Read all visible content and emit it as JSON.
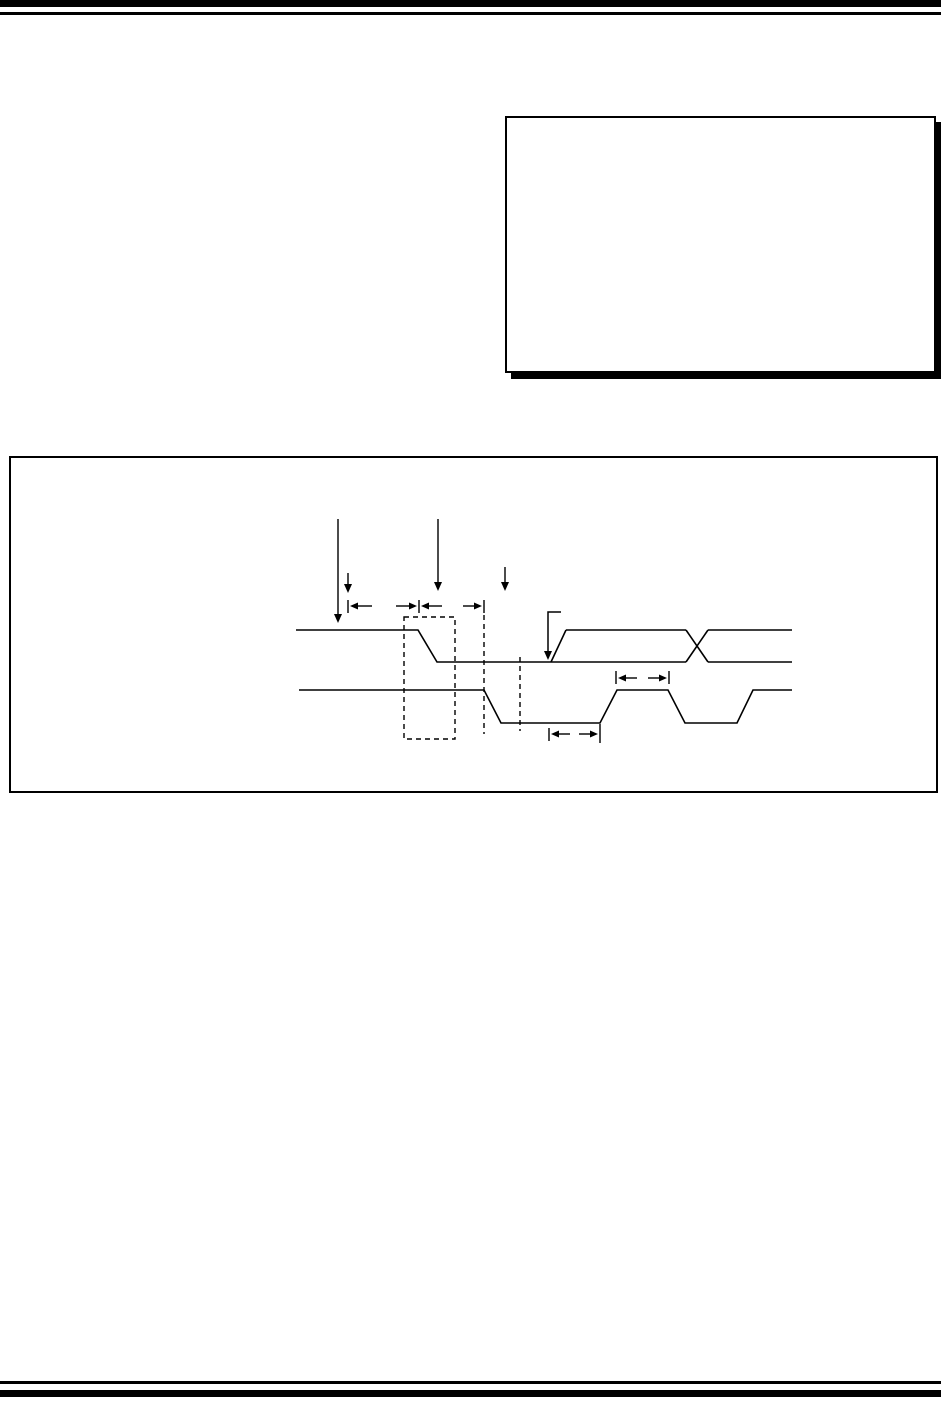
{
  "colors": {
    "ink": "#000000",
    "paper": "#ffffff"
  },
  "figure": {
    "type": "timing-diagram",
    "signals": [
      {
        "name": "signal1-high-fall-low",
        "points": "296,630 418,630 437,662 686,662"
      },
      {
        "name": "signal1-rising-edge",
        "points": "551,662 566,630"
      },
      {
        "name": "signal1-high-segment",
        "points": "566,630 686,630"
      },
      {
        "name": "signal1-crossover-fall",
        "points": "686,630 708,662"
      },
      {
        "name": "signal1-crossover-rise",
        "points": "686,662 708,630"
      },
      {
        "name": "signal1-high-tail",
        "points": "708,630 792,630"
      },
      {
        "name": "signal1-low-tail",
        "points": "708,662 792,662"
      },
      {
        "name": "signal2-waveform",
        "points": "299,690 484,690 501,723 600,723 617,690 668,690 685,723 737,723 753,690 792,690"
      }
    ],
    "down_arrows": [
      {
        "name": "tall-down-arrow-left",
        "x": 338,
        "y1": 519,
        "y2": 623
      },
      {
        "name": "tall-down-arrow-mid",
        "x": 438,
        "y1": 519,
        "y2": 591
      },
      {
        "name": "short-down-arrow-left",
        "x": 348,
        "y1": 573,
        "y2": 593
      },
      {
        "name": "short-down-arrow-mid",
        "x": 505,
        "y1": 567,
        "y2": 591
      }
    ],
    "corner_arrow": {
      "name": "corner-pointer-arrow",
      "points": "561,612 548,612 548,652",
      "tip_x": 548,
      "tip_y": 660
    },
    "ticks": [
      {
        "x": 348,
        "y1": 600,
        "y2": 613
      },
      {
        "x": 419,
        "y1": 600,
        "y2": 613
      },
      {
        "x": 484,
        "y1": 600,
        "y2": 613
      },
      {
        "x": 616,
        "y1": 671,
        "y2": 684
      },
      {
        "x": 669,
        "y1": 671,
        "y2": 684
      },
      {
        "x": 549,
        "y1": 728,
        "y2": 741
      },
      {
        "x": 600,
        "y1": 724,
        "y2": 743
      }
    ],
    "h_arrows": [
      {
        "tip_x": 350,
        "y": 606,
        "dir": "left",
        "tail": 14
      },
      {
        "tip_x": 417,
        "y": 606,
        "dir": "right",
        "tail": 13
      },
      {
        "tip_x": 421,
        "y": 606,
        "dir": "left",
        "tail": 13
      },
      {
        "tip_x": 482,
        "y": 606,
        "dir": "right",
        "tail": 11
      },
      {
        "tip_x": 618,
        "y": 678,
        "dir": "left",
        "tail": 11
      },
      {
        "tip_x": 667,
        "y": 678,
        "dir": "right",
        "tail": 11
      },
      {
        "tip_x": 551,
        "y": 734,
        "dir": "left",
        "tail": 11
      },
      {
        "tip_x": 598,
        "y": 734,
        "dir": "right",
        "tail": 11
      }
    ],
    "dashed_rect": {
      "x": 404,
      "y": 617,
      "w": 51,
      "h": 122
    },
    "dashed_lines": [
      {
        "name": "dashed-ref-line-1",
        "x": 484,
        "y1": 615,
        "y2": 734
      },
      {
        "name": "dashed-ref-line-2",
        "x": 520,
        "y1": 657,
        "y2": 731
      }
    ]
  }
}
